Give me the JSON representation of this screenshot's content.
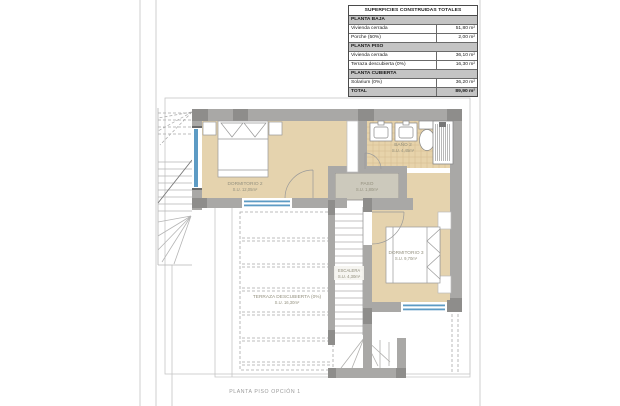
{
  "page": {
    "caption": "PLANTA PISO OPCIÓN 1"
  },
  "table": {
    "title": "SUPERFICIES CONSTRUIDAS TOTALES",
    "rows": [
      {
        "label": "PLANTA BAJA",
        "value": ""
      },
      {
        "label": "Vivienda cerrada",
        "value": "51,80 m²"
      },
      {
        "label": "Porche (50%)",
        "value": "2,00 m²"
      },
      {
        "label": "PLANTA PISO",
        "value": ""
      },
      {
        "label": "Vivienda cerrada",
        "value": "36,10 m²"
      },
      {
        "label": "Terraza descubierta (0%)",
        "value": "16,30 m²"
      },
      {
        "label": "PLANTA CUBIERTA",
        "value": ""
      },
      {
        "label": "Solarium (0%)",
        "value": "36,20 m²"
      },
      {
        "label": "TOTAL",
        "value": "89,90 m²"
      }
    ]
  },
  "rooms": {
    "dormitorio2": {
      "name": "DORMITORIO 2",
      "area": "S.U. 12,05m²"
    },
    "bano2": {
      "name": "BAÑO 2",
      "area": "S.U. 4,45m²"
    },
    "paso": {
      "name": "PASO",
      "area": "S.U. 1,80m²"
    },
    "escalera": {
      "name": "ESCALERA",
      "area": "S.U. 4,30m²"
    },
    "dormitorio3": {
      "name": "DORMITORIO 3",
      "area": "S.U. 9,70m²"
    },
    "terraza": {
      "name": "TERRAZA DESCUBIERTA (0%)",
      "area": "S.U. 16,30m²"
    }
  },
  "colors": {
    "wall": "#a9a8a6",
    "pillar": "#8e8d8b",
    "floor_beige": "#e5d3ae",
    "bath_tile": "#e7d3aa",
    "paso_floor": "#ccc9bc",
    "window_blue": "#5d9bc4"
  }
}
